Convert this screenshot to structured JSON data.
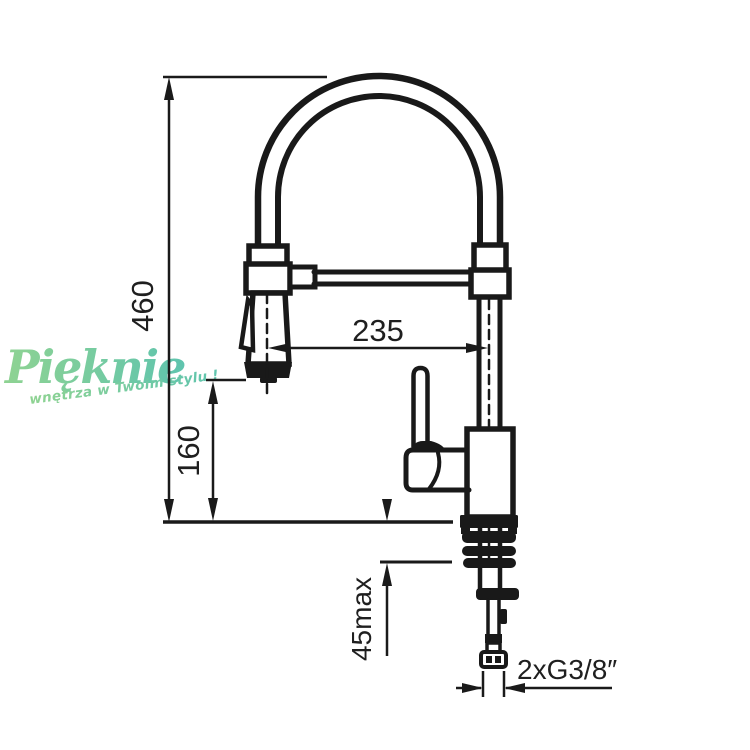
{
  "watermark": {
    "brand": "Pięknie",
    "tagline": "wnętrza w Twoim stylu !",
    "color_start": "#8fd392",
    "color_end": "#5fc4ae"
  },
  "drawing": {
    "line_color": "#1a1a1a",
    "labels": {
      "overall_height": "460",
      "spray_head_height": "160",
      "spout_reach": "235",
      "max_counter_thickness": "45max",
      "supply_connection": "2xG3/8″"
    }
  }
}
